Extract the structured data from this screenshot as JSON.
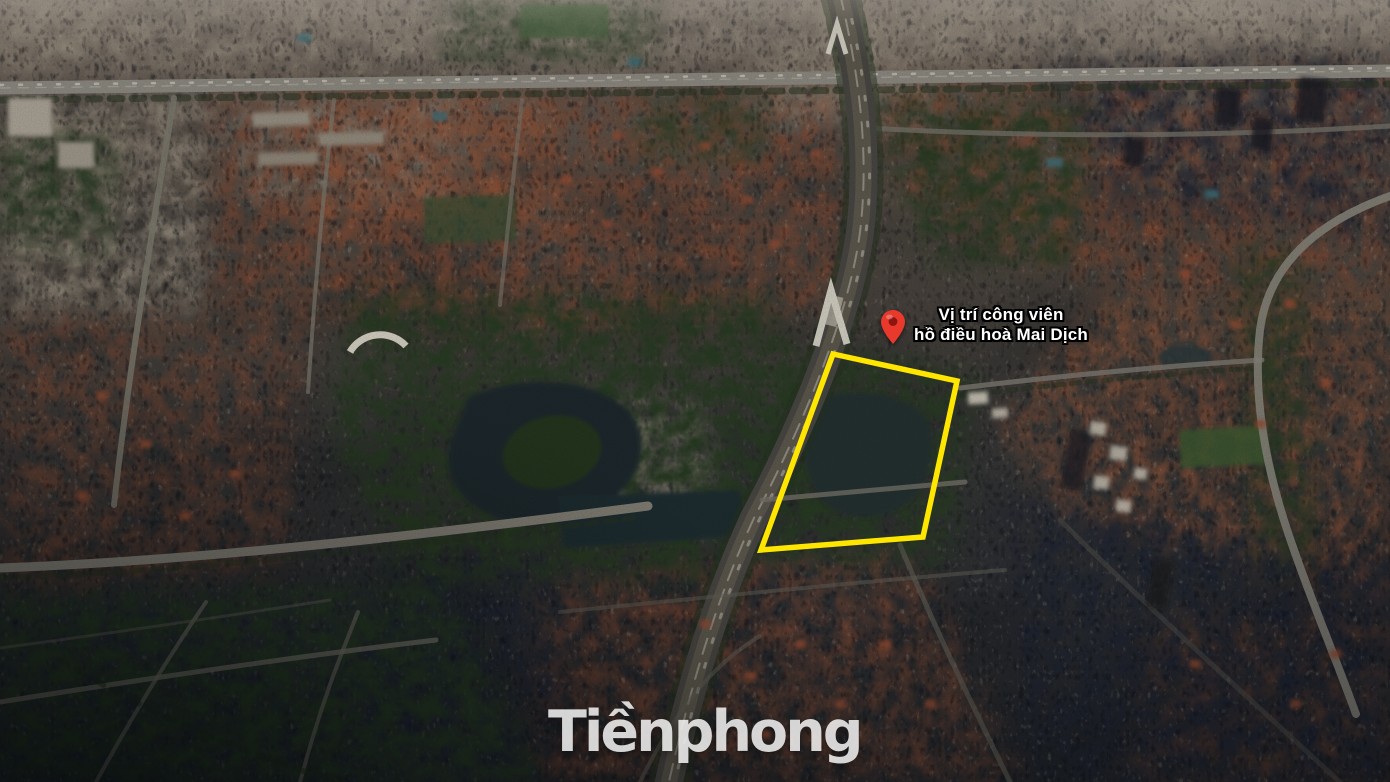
{
  "annotation": {
    "pin": {
      "icon": "location-pin-icon",
      "color": "#e8392c",
      "inner_color": "#8e1410",
      "x": 893,
      "y": 344
    },
    "label": {
      "line1": "Vị trí công viên",
      "line2": "hồ điều hoà Mai Dịch",
      "text_color": "#ffffff",
      "outline_color": "#000000"
    },
    "highlight": {
      "shape": "polygon",
      "points": "833,354 957,381 923,537 761,550",
      "stroke": "#ffe600",
      "stroke_width": 5.5,
      "fill": "none"
    }
  },
  "watermark": {
    "text": "Tiềnphong",
    "color": "#ffffff",
    "opacity": 0.8
  },
  "palette": {
    "haze_top": "#7d746a",
    "urban_mid": "#46403b",
    "urban_dark": "#2c2d30",
    "roof_brown": "#78452f",
    "park_green": "#283824",
    "water": "#1e2a2c",
    "road_light": "#85827a",
    "asphalt": "#575349"
  }
}
